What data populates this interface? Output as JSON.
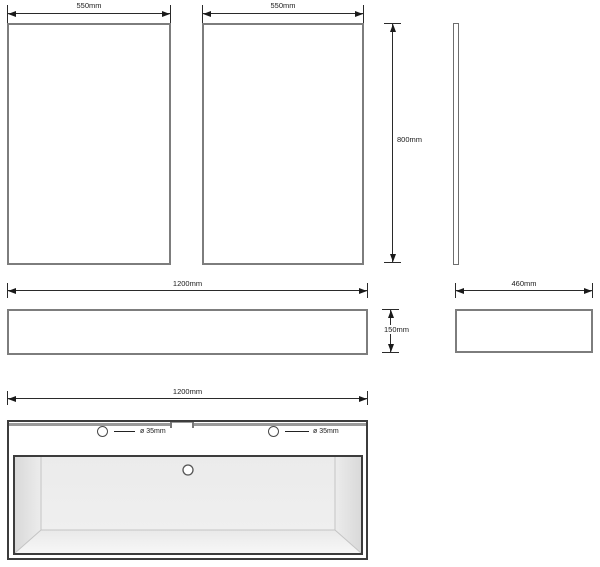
{
  "drawing": {
    "type": "furniture technical drawing - wall-hung vanity unit with basin",
    "labels": {
      "panel_left_width": "550mm",
      "panel_right_width": "550mm",
      "panel_height": "800mm",
      "plinth_width": "1200mm",
      "plinth_height": "150mm",
      "side_depth": "460mm",
      "basin_width": "1200mm",
      "tap_hole_left": "ø 35mm",
      "tap_hole_right": "ø 35mm"
    },
    "colors": {
      "outline_gray": "#7d7d7d",
      "outline_dark": "#3c3c3c",
      "dimension_line": "#1a1a1a",
      "back_edge_band": "#9a9a9a",
      "basin_floor": "#ececec",
      "basin_wall_shadow": "#d9d9d9",
      "basin_slope_highlight": "#f7f7f7",
      "background": "#ffffff"
    }
  }
}
